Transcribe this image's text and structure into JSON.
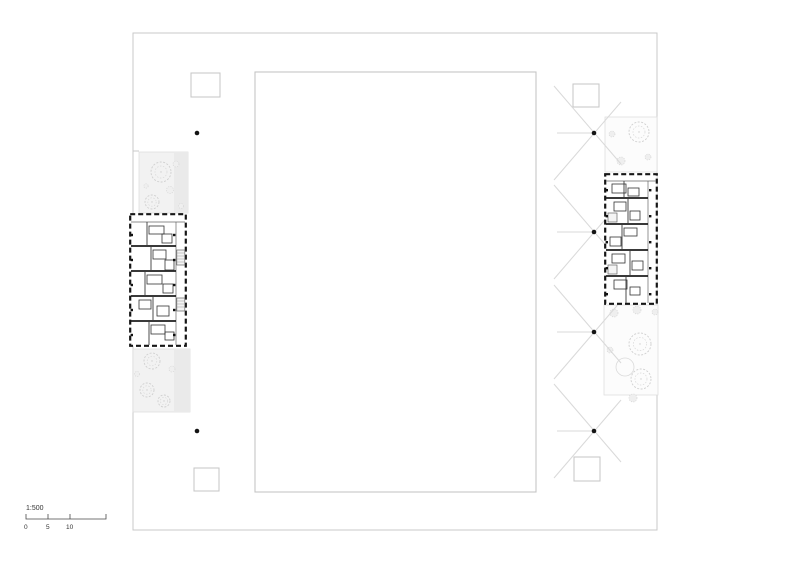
{
  "page": {
    "width": 800,
    "height": 565,
    "background": "#ffffff",
    "type": "architectural-site-plan"
  },
  "scale_bar": {
    "ratio": "1:500",
    "ticks": [
      "0",
      "5",
      "10"
    ]
  },
  "colors": {
    "background": "#ffffff",
    "boundary_line": "#c9c9c9",
    "courtyard_line": "#c5c5c5",
    "landscape_line": "#dedede",
    "paving_band": "#eaeaea",
    "wall": "#1a1a1a",
    "mark_line": "#d9d9d9",
    "dot": "#141414",
    "tree_line": "#d2d2d2",
    "text": "#333333"
  },
  "plan": {
    "boundary": {
      "x": 133,
      "y": 33,
      "width": 524,
      "height": 497
    },
    "boundary_step": {
      "x1": 133,
      "y1": 151,
      "x2": 139,
      "y2": 151
    },
    "courtyard": {
      "x": 255,
      "y": 72,
      "width": 281,
      "height": 420
    },
    "rooflight_squares": [
      {
        "x": 191,
        "y": 73,
        "width": 29,
        "height": 24
      },
      {
        "x": 573,
        "y": 84,
        "width": 26,
        "height": 23
      },
      {
        "x": 194,
        "y": 468,
        "width": 25,
        "height": 23
      },
      {
        "x": 574,
        "y": 457,
        "width": 26,
        "height": 24
      }
    ],
    "landscape_areas": [
      {
        "id": "west-upper",
        "x": 139,
        "y": 152,
        "width": 49,
        "height": 61,
        "fill": "#f2f2f2"
      },
      {
        "id": "west-lower",
        "x": 133,
        "y": 349,
        "width": 57,
        "height": 63,
        "fill": "#f2f2f2"
      },
      {
        "id": "east-upper",
        "x": 605,
        "y": 117,
        "width": 52,
        "height": 55,
        "fill": "#fcfcfc"
      },
      {
        "id": "east-lower",
        "x": 604,
        "y": 305,
        "width": 54,
        "height": 90,
        "fill": "#fcfcfc"
      }
    ],
    "paving_bands": [
      {
        "x": 174,
        "y": 152,
        "width": 14,
        "height": 61
      },
      {
        "x": 174,
        "y": 349,
        "width": 16,
        "height": 63
      }
    ],
    "trees": [
      {
        "type": "canopy",
        "cx": 161,
        "cy": 172,
        "r": 10
      },
      {
        "type": "shrub",
        "cx": 176,
        "cy": 164,
        "r": 3
      },
      {
        "type": "shrub",
        "cx": 170,
        "cy": 190,
        "r": 3.5
      },
      {
        "type": "canopy",
        "cx": 152,
        "cy": 202,
        "r": 7
      },
      {
        "type": "shrub",
        "cx": 181,
        "cy": 206,
        "r": 2.5
      },
      {
        "type": "shrub",
        "cx": 146,
        "cy": 186,
        "r": 2.2
      },
      {
        "type": "canopy",
        "cx": 152,
        "cy": 361,
        "r": 8
      },
      {
        "type": "canopy",
        "cx": 147,
        "cy": 390,
        "r": 7
      },
      {
        "type": "canopy",
        "cx": 164,
        "cy": 401,
        "r": 6
      },
      {
        "type": "shrub",
        "cx": 172,
        "cy": 369,
        "r": 3
      },
      {
        "type": "shrub",
        "cx": 137,
        "cy": 374,
        "r": 2.5
      },
      {
        "type": "canopy",
        "cx": 639,
        "cy": 132,
        "r": 10
      },
      {
        "type": "shrub",
        "cx": 612,
        "cy": 134,
        "r": 3
      },
      {
        "type": "shrub",
        "cx": 621,
        "cy": 161,
        "r": 4
      },
      {
        "type": "shrub",
        "cx": 648,
        "cy": 157,
        "r": 3
      },
      {
        "type": "canopy",
        "cx": 640,
        "cy": 344,
        "r": 11
      },
      {
        "type": "canopy",
        "cx": 641,
        "cy": 379,
        "r": 10
      },
      {
        "type": "ring",
        "cx": 625,
        "cy": 367,
        "r": 9
      },
      {
        "type": "shrub",
        "cx": 614,
        "cy": 313,
        "r": 4
      },
      {
        "type": "shrub",
        "cx": 637,
        "cy": 310,
        "r": 4
      },
      {
        "type": "shrub",
        "cx": 610,
        "cy": 350,
        "r": 3
      },
      {
        "type": "shrub",
        "cx": 633,
        "cy": 398,
        "r": 4
      },
      {
        "type": "shrub",
        "cx": 655,
        "cy": 312,
        "r": 3
      }
    ],
    "x_marks": [
      {
        "cx": 594,
        "cy": 133
      },
      {
        "cx": 594,
        "cy": 232
      },
      {
        "cx": 594,
        "cy": 332
      },
      {
        "cx": 594,
        "cy": 431
      }
    ],
    "survey_dots": [
      {
        "cx": 197,
        "cy": 133
      },
      {
        "cx": 197,
        "cy": 431
      },
      {
        "cx": 594,
        "cy": 133
      },
      {
        "cx": 594,
        "cy": 232
      },
      {
        "cx": 594,
        "cy": 332
      },
      {
        "cx": 594,
        "cy": 431
      }
    ],
    "buildings": [
      {
        "id": "west",
        "x": 129,
        "y": 213,
        "width": 58,
        "height": 134
      },
      {
        "id": "east",
        "x": 604,
        "y": 173,
        "width": 54,
        "height": 132
      }
    ]
  }
}
